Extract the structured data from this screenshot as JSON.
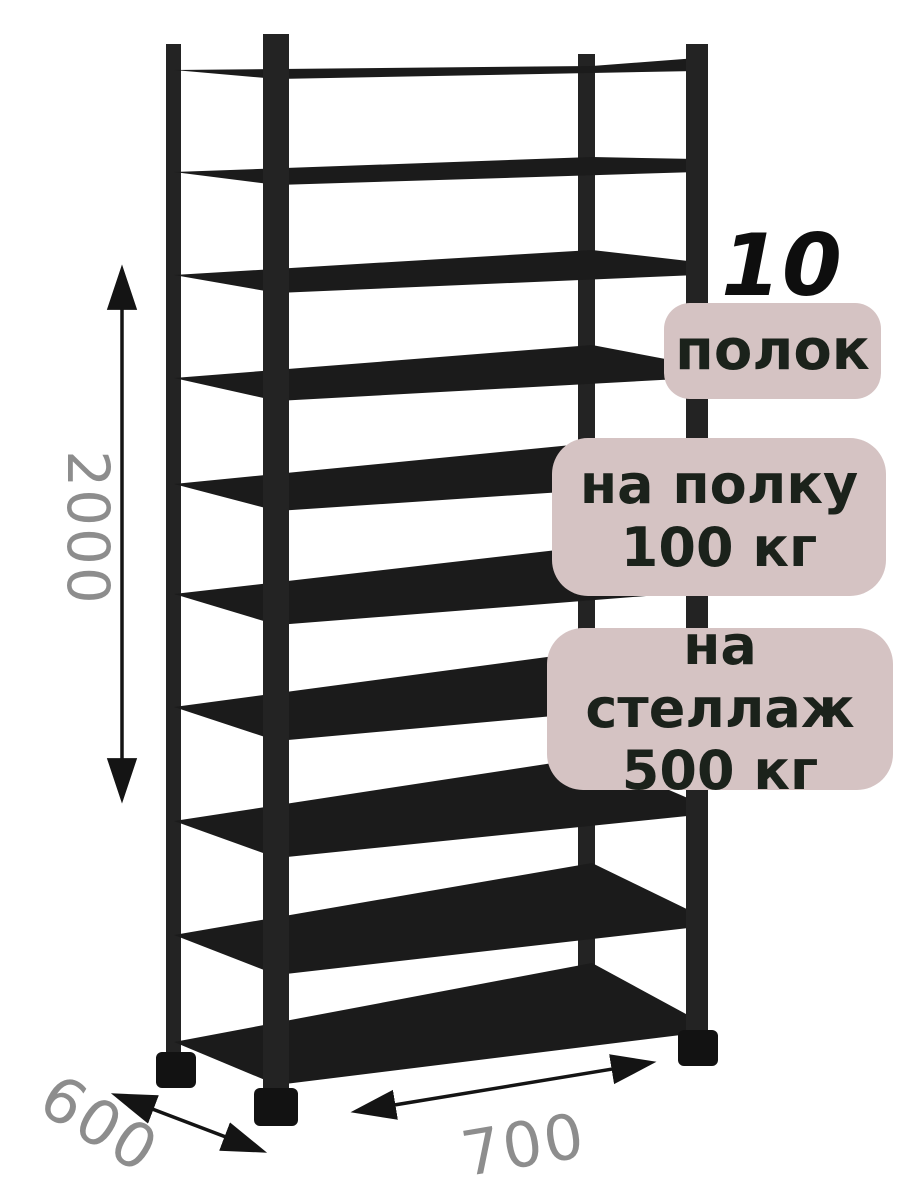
{
  "badges": {
    "count": {
      "value": "10",
      "label": "полок"
    },
    "per_shelf": {
      "line1": "на полку",
      "line2": "100 кг"
    },
    "per_rack": {
      "line1": "на стеллаж",
      "line2": "500 кг"
    }
  },
  "dimensions": {
    "height_mm": "2000",
    "depth_mm": "600",
    "width_mm": "700"
  },
  "rack": {
    "shelf_count": 10
  },
  "colors": {
    "background": "#ffffff",
    "rack": "#1b1b1b",
    "post": "#232323",
    "foot": "#121212",
    "badge_bg": "#d5c3c3",
    "badge_text": "#1b221b",
    "count_number": "#0e0e0e",
    "dimension_text": "#8d8d8d",
    "arrow": "#141414"
  }
}
